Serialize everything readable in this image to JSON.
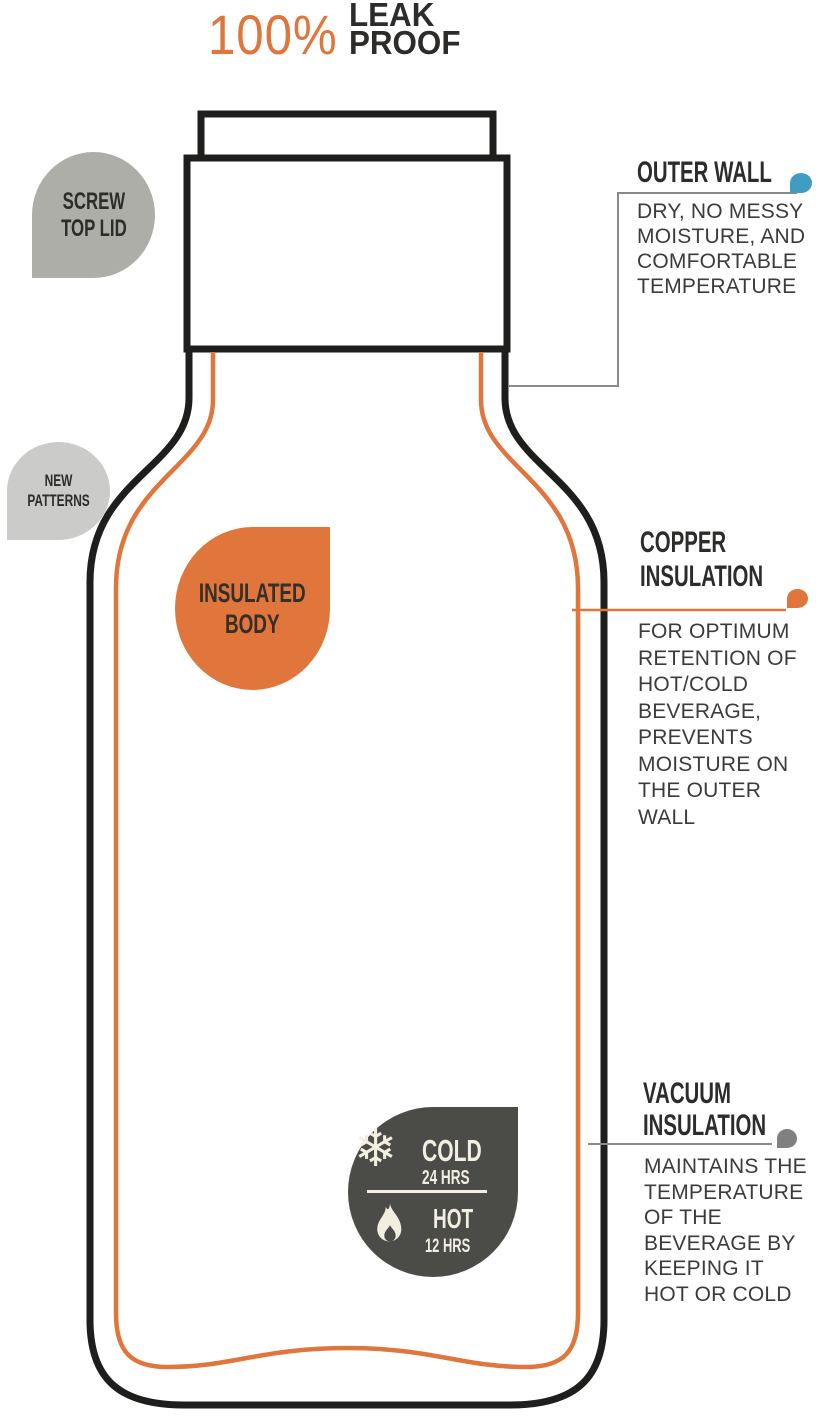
{
  "title": {
    "percent": "100%",
    "leak": "LEAK",
    "proof": "PROOF"
  },
  "badges": {
    "screw_top_lid": {
      "lines": [
        "SCREW",
        "TOP LID"
      ]
    },
    "new_patterns": {
      "lines": [
        "NEW",
        "PATTERNS"
      ]
    },
    "insulated_body": {
      "lines": [
        "INSULATED",
        "BODY"
      ]
    },
    "temperature": {
      "snowflake_glyph": "❄",
      "cold_label": "COLD",
      "cold_duration": "24 HRS",
      "hot_label": "HOT",
      "hot_duration": "12 HRS"
    }
  },
  "annotations": {
    "outer_wall": {
      "heading": "OUTER WALL",
      "body": "DRY, NO MESSY\nMOISTURE, AND\nCOMFORTABLE\nTEMPERATURE"
    },
    "copper_insulation": {
      "heading": "COPPER\nINSULATION",
      "body": "FOR OPTIMUM\nRETENTION OF\nHOT/COLD\nBEVERAGE,\nPREVENTS\nMOISTURE ON\nTHE OUTER\nWALL"
    },
    "vacuum_insulation": {
      "heading": "VACUUM\nINSULATION",
      "body": "MAINTAINS THE\nTEMPERATURE\nOF THE\nBEVERAGE BY\nKEEPING IT\nHOT OR COLD"
    }
  },
  "colors": {
    "orange": "#E0763B",
    "outline": "#1E1E1C",
    "heading_ink": "#2D2C2B",
    "body_ink": "#3C3B3A",
    "badge_gray": "#AEAEA9",
    "badge_light_gray": "#CBCBC9",
    "badge_dark": "#4B4B47",
    "cream": "#F2EFE1",
    "blue": "#3F9CC2",
    "leader_gray": "#8A8A8A",
    "gray_dot": "#808080"
  }
}
